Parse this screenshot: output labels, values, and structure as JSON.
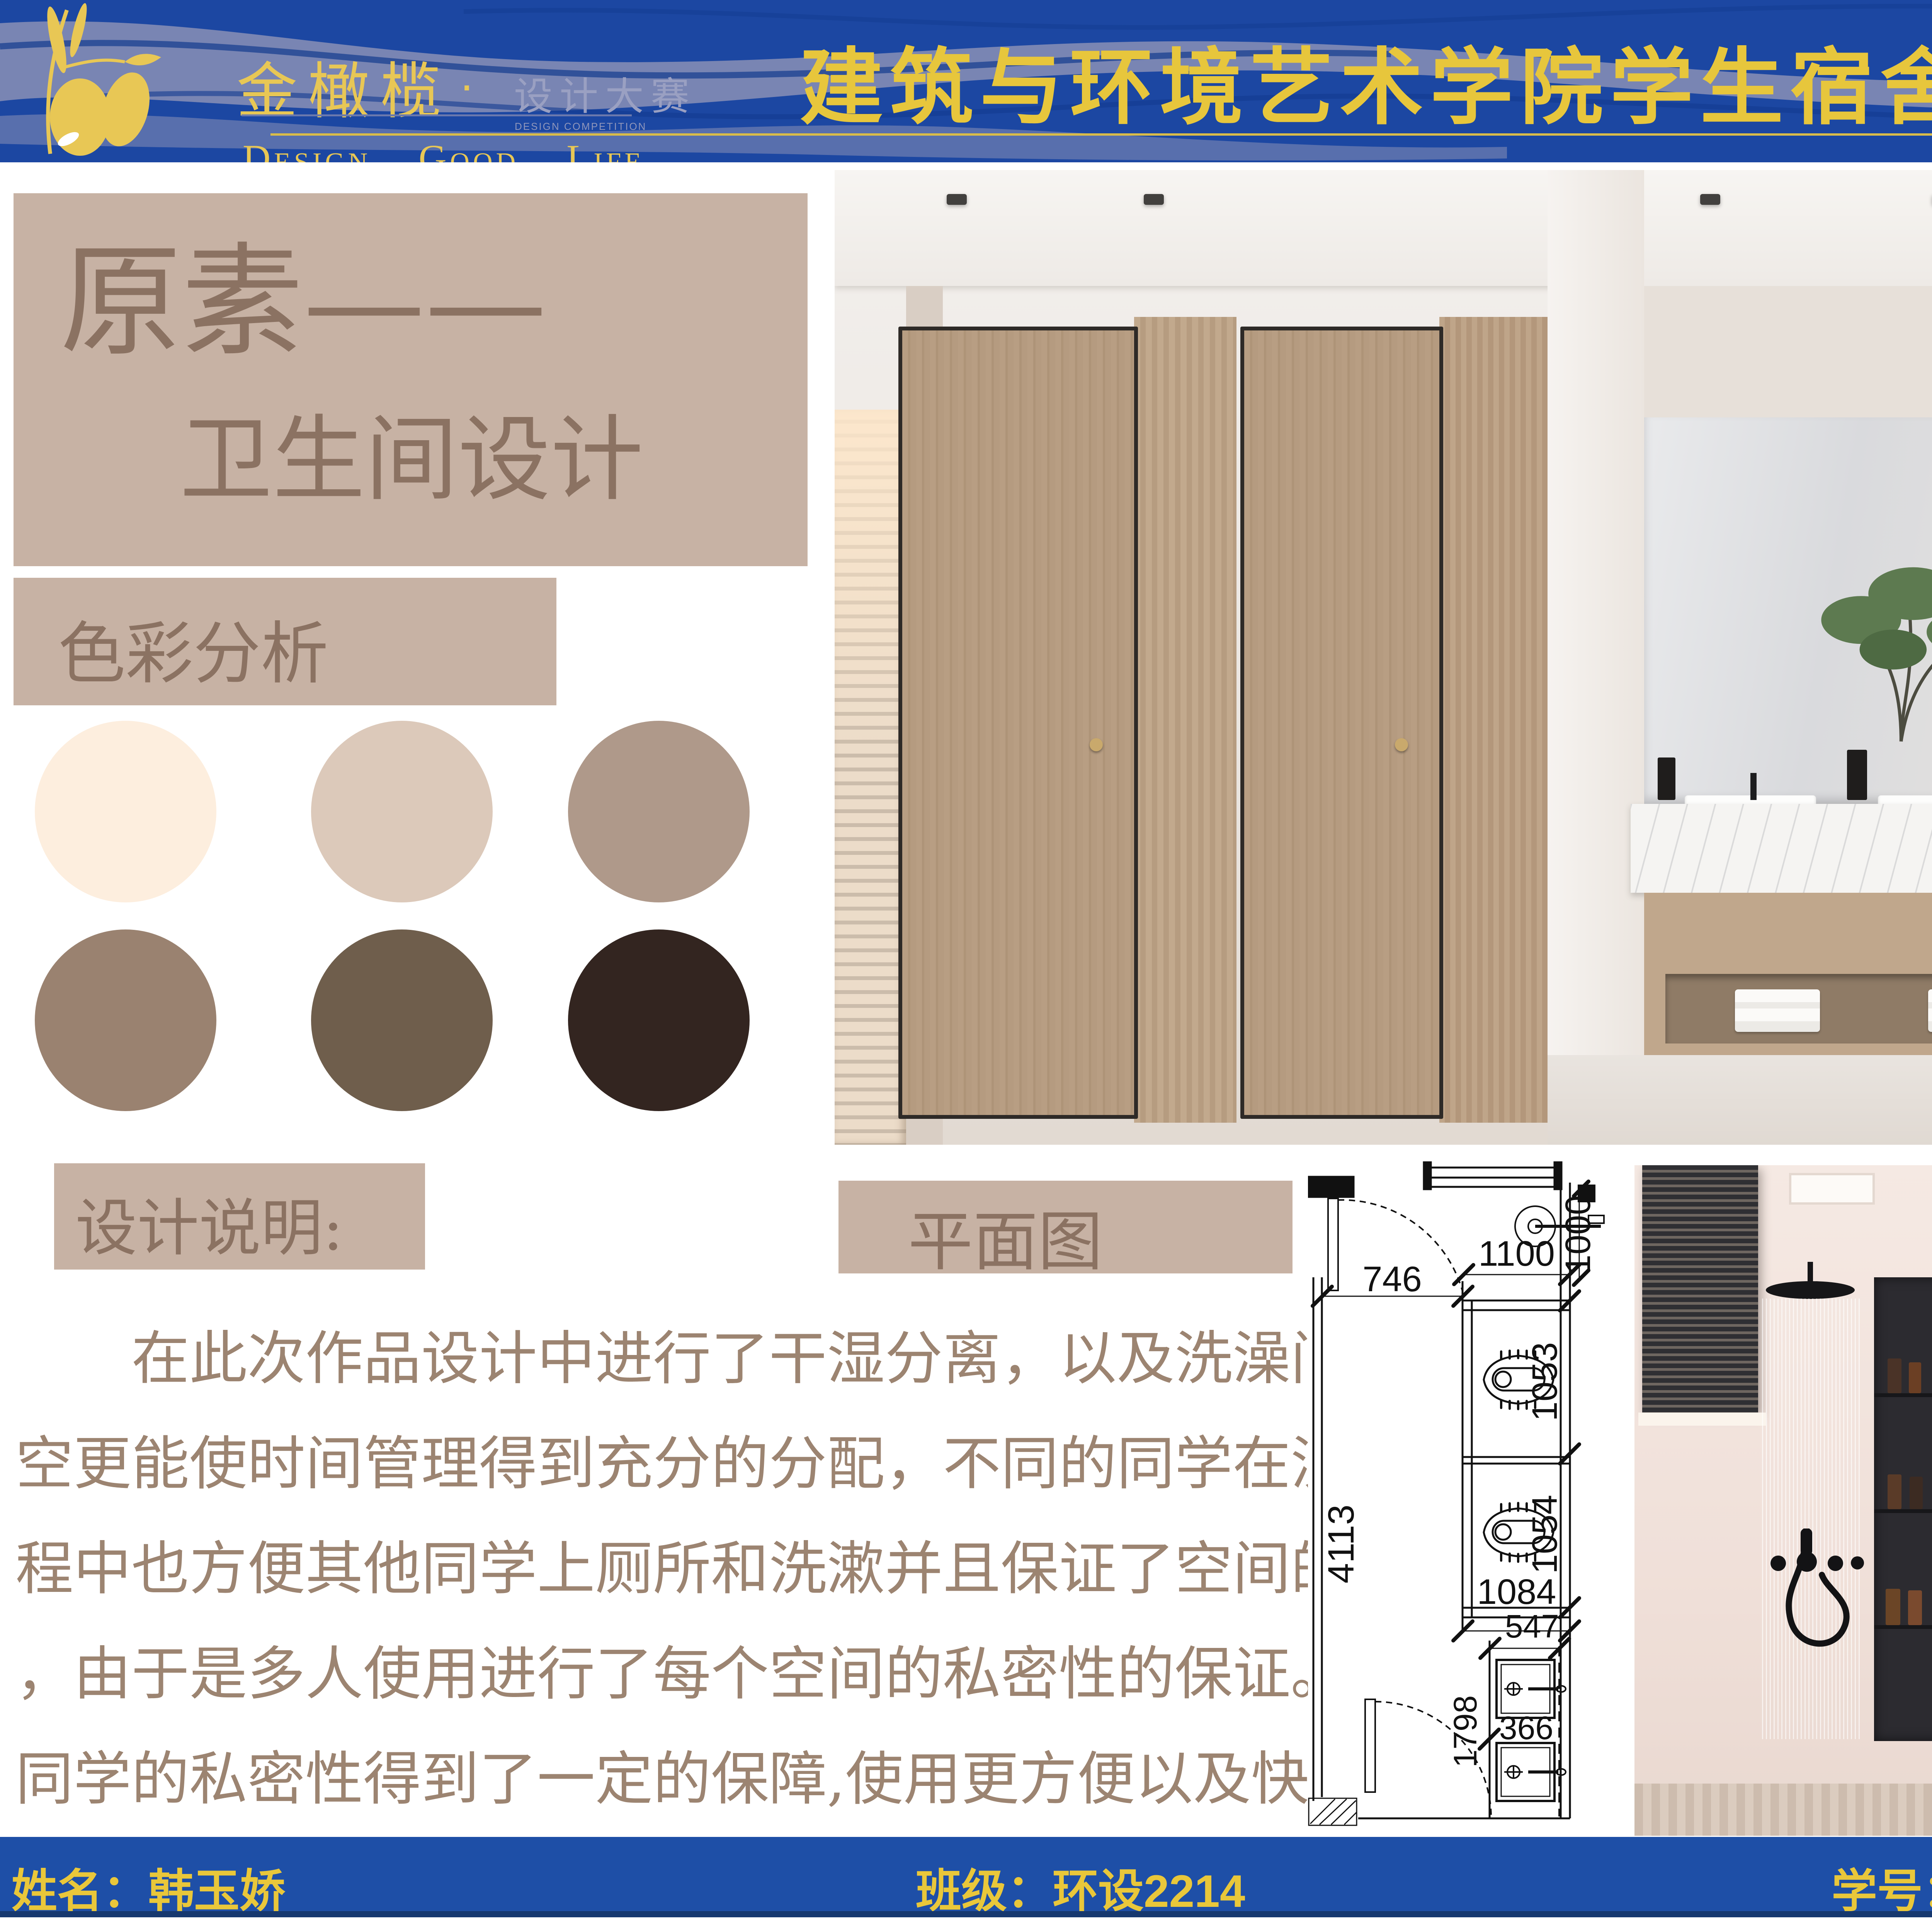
{
  "header": {
    "band_color": "#1c47a2",
    "wave_color": "#8a90b6",
    "accent_gold": "#e7c63c",
    "logo": {
      "brand": "金橄榄",
      "dot": "·",
      "program": "设计大赛",
      "program_en": "DESIGN COMPETITION",
      "tagline_words": [
        "Design.",
        "Good.",
        "Life"
      ]
    },
    "title": "建筑与环境艺术学院学生宿舍卫生间设计大赛"
  },
  "poster_title": {
    "line1": "原素——",
    "line2": "卫生间设计"
  },
  "sections": {
    "color_analysis": "色彩分析",
    "design_notes": "设计说明:",
    "floor_plan": "平面图"
  },
  "palette": {
    "swatches": [
      "#fdeede",
      "#dcc9ba",
      "#af998a",
      "#9a8270",
      "#6f5e4c",
      "#332520"
    ]
  },
  "design_description": {
    "lines": [
      "在此次作品设计中进行了干湿分离，以及洗澡间的独立",
      "空更能使时间管理得到充分的分配，不同的同学在洗澡的过",
      "程中也方便其他同学上厕所和洗漱并且保证了空间的独立性",
      "，由于是多人使用进行了每个空间的私密性的保证。让每位",
      "同学的私密性得到了一定的保障,使用更方便以及快捷。"
    ]
  },
  "floor_plan": {
    "dims": {
      "left_total": "4113",
      "corridor": "746",
      "stall_width": "1100",
      "basin_offset": "1000",
      "stall1_depth": "1053",
      "stall2_depth": "1054",
      "stall_bottom": "1084",
      "wash_width": "547",
      "wash_depth": "1798",
      "basin_width": "366"
    }
  },
  "footer": {
    "name": "姓名：韩玉娇",
    "class": "班级：环设2214",
    "student_id": "学号：202240397"
  }
}
